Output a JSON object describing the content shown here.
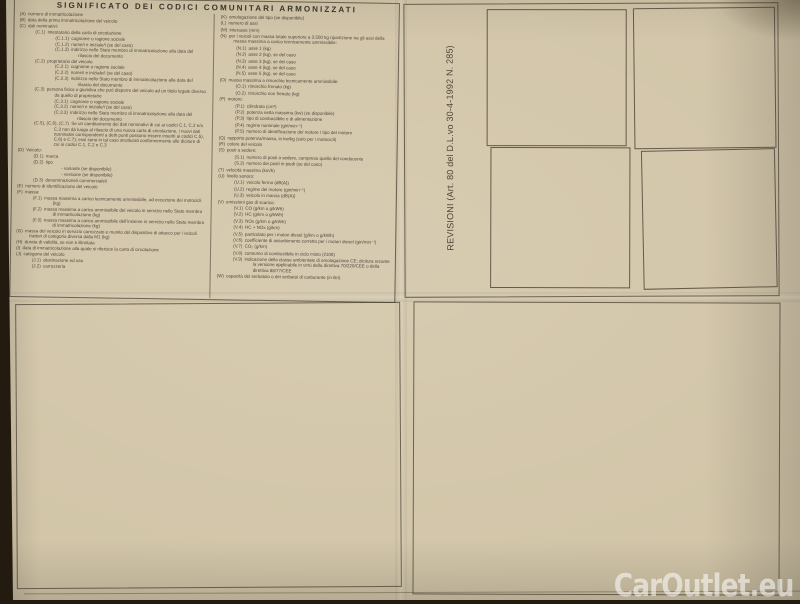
{
  "page": {
    "watermark": "CarOutlet.eu"
  },
  "codes_panel": {
    "title": "SIGNIFICATO DEI CODICI COMUNITARI ARMONIZZATI",
    "left_column": [
      {
        "code": "(A)",
        "text": "numero di immatricolazione",
        "indent": 0
      },
      {
        "code": "(B)",
        "text": "data della prima immatricolazione del veicolo",
        "indent": 0
      },
      {
        "code": "(C)",
        "text": "dati nominativi:",
        "indent": 0
      },
      {
        "code": "(C.1)",
        "text": "intestatario della carta di circolazione",
        "indent": 1
      },
      {
        "code": "(C.1.1)",
        "text": "cognome o ragione sociale",
        "indent": 2
      },
      {
        "code": "(C.1.2)",
        "text": "nome/i e iniziale/i (se del caso)",
        "indent": 2
      },
      {
        "code": "(C.1.3)",
        "text": "indirizzo nello Stato membro di immatricolazione alla data del rilascio del documento",
        "indent": 2
      },
      {
        "code": "(C.2)",
        "text": "proprietario del veicolo",
        "indent": 1
      },
      {
        "code": "(C.2.1)",
        "text": "cognome o ragione sociale",
        "indent": 2
      },
      {
        "code": "(C.2.2)",
        "text": "nome/i e iniziale/i (se del caso)",
        "indent": 2
      },
      {
        "code": "(C.2.3)",
        "text": "indirizzo nello Stato membro di immatricolazione alla data del rilascio del documento",
        "indent": 2
      },
      {
        "code": "(C.3)",
        "text": "persona fisica o giuridica che può disporre del veicolo ad un titolo legale diverso da quello di proprietario",
        "indent": 1
      },
      {
        "code": "(C.3.1)",
        "text": "cognome o ragione sociale",
        "indent": 2
      },
      {
        "code": "(C.3.2)",
        "text": "nome/i e iniziale/i (se del caso)",
        "indent": 2
      },
      {
        "code": "(C.3.3)",
        "text": "indirizzo nello Stato membro di immatricolazione alla data del rilascio del documento",
        "indent": 2
      },
      {
        "code": "(C.5), (C.6), (C.7)",
        "text": "Se un cambiamento dei dati nominativi di cui ai codici C.1, C.2 e/o C.3 non dà luogo al rilascio di una nuova carta di circolazione, i nuovi dati nominativi corrispondenti a detti punti possono essere inseriti ai codici C.5), C.6) e C.7); essi sono in tal caso strutturati conformemente alle diciture di cui ai codici C.1, C.2 e C.3",
        "indent": 1
      },
      {
        "code": "(D)",
        "text": "Veicolo:",
        "indent": 0
      },
      {
        "code": "(D.1)",
        "text": "marca",
        "indent": 1
      },
      {
        "code": "(D.2)",
        "text": "tipo",
        "indent": 1
      },
      {
        "code": "",
        "text": "- variante (se disponibile)",
        "indent": 2
      },
      {
        "code": "",
        "text": "- versione (se disponibile)",
        "indent": 2
      },
      {
        "code": "(D.3)",
        "text": "denominazione/i commerciale/i",
        "indent": 1
      },
      {
        "code": "(E)",
        "text": "numero di identificazione del veicolo",
        "indent": 0
      },
      {
        "code": "(F)",
        "text": "massa:",
        "indent": 0
      },
      {
        "code": "(F.1)",
        "text": "massa massima a carico tecnicamente ammissibile, ad eccezione dei motocicli (kg)",
        "indent": 1
      },
      {
        "code": "(F.2)",
        "text": "massa massima a carico ammissibile del veicolo in servizio nello Stato membro di immatricolazione (kg)",
        "indent": 1
      },
      {
        "code": "(F.3)",
        "text": "massa massima a carico ammissibile dell'insieme in servizio nello Stato membro di immatricolazione (kg)",
        "indent": 1
      },
      {
        "code": "(G)",
        "text": "massa del veicolo in servizio carrozzato e munito del dispositivo di attacco per i veicoli trattori di categoria diversa dalla M1 (kg)",
        "indent": 0
      },
      {
        "code": "(H)",
        "text": "durata di validità, se non è illimitata",
        "indent": 0
      },
      {
        "code": "(I)",
        "text": "data di immatricolazione alla quale si riferisce la carta di circolazione",
        "indent": 0
      },
      {
        "code": "(J)",
        "text": "categoria del veicolo",
        "indent": 0
      },
      {
        "code": "(J.1)",
        "text": "destinazione ed uso",
        "indent": 1
      },
      {
        "code": "(J.2)",
        "text": "carrozzeria",
        "indent": 1
      }
    ],
    "right_column": [
      {
        "code": "(K)",
        "text": "omologazione del tipo (se disponibile)",
        "indent": 0
      },
      {
        "code": "(L)",
        "text": "numero di assi",
        "indent": 0
      },
      {
        "code": "(M)",
        "text": "interasse (mm)",
        "indent": 0
      },
      {
        "code": "(N)",
        "text": "per i veicoli con massa totale superiore a 3.500 kg ripartizione tra gli assi della massa massima a carico tecnicamente ammissibile:",
        "indent": 0
      },
      {
        "code": "(N.1)",
        "text": "asse 1 (kg)",
        "indent": 1
      },
      {
        "code": "(N.2)",
        "text": "asse 2 (kg), se del caso",
        "indent": 1
      },
      {
        "code": "(N.3)",
        "text": "asse 3 (kg), se del caso",
        "indent": 1
      },
      {
        "code": "(N.4)",
        "text": "asse 4 (kg), se del caso",
        "indent": 1
      },
      {
        "code": "(N.5)",
        "text": "asse 5 (kg), se del caso",
        "indent": 1
      },
      {
        "code": "(O)",
        "text": "massa massima a rimorchio tecnicamente ammissibile:",
        "indent": 0
      },
      {
        "code": "(O.1)",
        "text": "rimorchio frenato (kg)",
        "indent": 1
      },
      {
        "code": "(O.2)",
        "text": "rimorchio non frenato (kg)",
        "indent": 1
      },
      {
        "code": "(P)",
        "text": "motore:",
        "indent": 0
      },
      {
        "code": "(P.1)",
        "text": "cilindrata (cm³)",
        "indent": 1
      },
      {
        "code": "(P.2)",
        "text": "potenza netta massima (kw) (se disponibile)",
        "indent": 1
      },
      {
        "code": "(P.3)",
        "text": "tipo di combustibile e di alimentazione",
        "indent": 1
      },
      {
        "code": "(P.4)",
        "text": "regime nominale (giri/min⁻¹)",
        "indent": 1
      },
      {
        "code": "(P.5)",
        "text": "numero di identificazione del motore / tipo del motore",
        "indent": 1
      },
      {
        "code": "(Q)",
        "text": "rapporto potenza/massa, in kw/kg (solo per i motocicli)",
        "indent": 0
      },
      {
        "code": "(R)",
        "text": "colore del veicolo",
        "indent": 0
      },
      {
        "code": "(S)",
        "text": "posti a sedere:",
        "indent": 0
      },
      {
        "code": "(S.1)",
        "text": "numero di posti a sedere, compreso quello del conducente",
        "indent": 1
      },
      {
        "code": "(S.2)",
        "text": "numero dei posti in piedi (se del caso)",
        "indent": 1
      },
      {
        "code": "(T)",
        "text": "velocità massima (km/h)",
        "indent": 0
      },
      {
        "code": "(U)",
        "text": "livello sonoro:",
        "indent": 0
      },
      {
        "code": "(U.1)",
        "text": "veicolo fermo (dB(A))",
        "indent": 1
      },
      {
        "code": "(U.2)",
        "text": "regime del motore (giri/min⁻¹)",
        "indent": 1
      },
      {
        "code": "(U.3)",
        "text": "veicolo in marcia (dB(A))",
        "indent": 1
      },
      {
        "code": "(V)",
        "text": "emissioni gas di scarico:",
        "indent": 0
      },
      {
        "code": "(V.1)",
        "text": "CO (g/km o g/kWh)",
        "indent": 1
      },
      {
        "code": "(V.2)",
        "text": "HC (g/km o g/kWh)",
        "indent": 1
      },
      {
        "code": "(V.3)",
        "text": "NOx (g/km o g/kWh)",
        "indent": 1
      },
      {
        "code": "(V.4)",
        "text": "HC + NOx (g/km)",
        "indent": 1
      },
      {
        "code": "(V.5)",
        "text": "particolato per i motori diesel (g/km o g/kWh)",
        "indent": 1
      },
      {
        "code": "(V.6)",
        "text": "coefficiente di assorbimento corretto per i motori diesel (giri/min⁻¹)",
        "indent": 1
      },
      {
        "code": "(V.7)",
        "text": "CO₂ (g/km)",
        "indent": 1
      },
      {
        "code": "(V.8)",
        "text": "consumo di combustibile in ciclo misto (l/100)",
        "indent": 1
      },
      {
        "code": "(V.9)",
        "text": "indicazione della classe ambientale di omologazione CE; dicitura recante la versione applicabile in virtù della direttiva 70/220/CEE o della direttiva 88/77/CEE",
        "indent": 1
      },
      {
        "code": "(W)",
        "text": "capacità del serbatoio o dei serbatoi di carburante (in litri)",
        "indent": 0
      }
    ]
  },
  "revisioni_panel": {
    "label": "REVISIONI (Art. 80 del D.L.vo 30-4-1992 N. 285)"
  }
}
